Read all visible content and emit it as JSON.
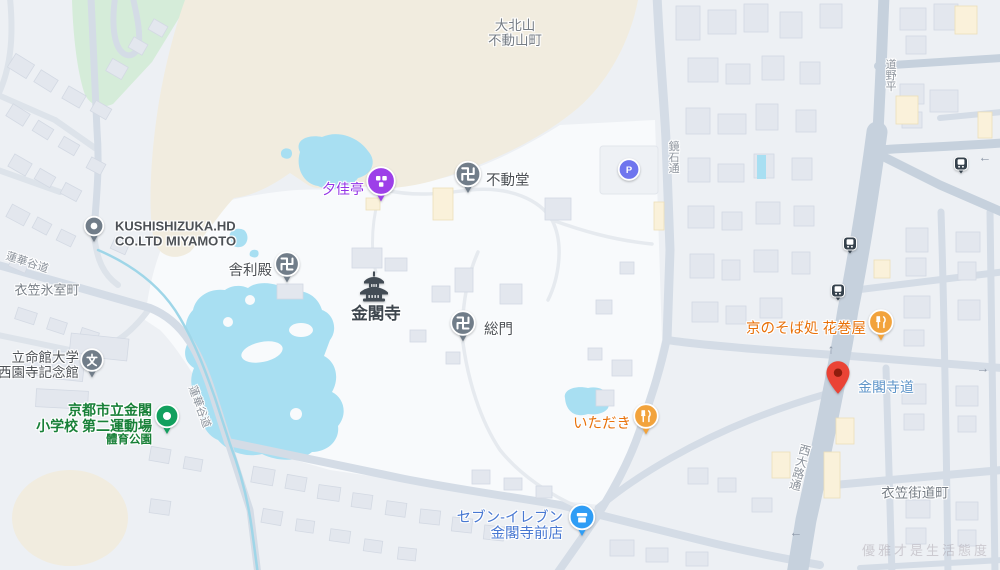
{
  "map": {
    "watermark": "優雅才是生活態度",
    "palette": {
      "features": {
        "land": "#edf0f4",
        "temple": "#f8fafc",
        "green": "#d5ecd9",
        "beige": "#f1ecdf",
        "water": "#a8dff2",
        "stream": "#9fd6e8",
        "roadMajor": "#c6d1dd",
        "roadMinor": "#d4dce6",
        "lane": "#dde3ea",
        "tpath": "#e6eaef",
        "bldg": "#e3e7ee",
        "bldgStroke": "#d3d9e3",
        "bldgBeige": "#faf1da",
        "bldgBeigeStroke": "#eddfb9"
      },
      "text": {
        "dark": "#4d5156",
        "kinkakuji": "#3e464e",
        "area": "#767d85",
        "road": "#8c939c",
        "purple": "#9334e6",
        "orange": "#e8710a",
        "blue": "#4878d2",
        "green": "#188038",
        "transit": "#5f95c9"
      },
      "markers": {
        "grey": "#717d89",
        "purple": "#9d3fe8",
        "orange": "#f2a33c",
        "blue": "#2f9df5",
        "green": "#12a05e",
        "parking": "#6f75ee",
        "bus": "#36424d",
        "pin_red": "#ea4335",
        "pin_red_dark": "#8f1d0d",
        "pagoda": "#434c55"
      }
    },
    "labels": [
      {
        "id": "daikitayama-fudosancho",
        "lines": [
          "大北山",
          "不動山町"
        ],
        "x": 515,
        "y": 33,
        "size": 13.5,
        "weight": 400,
        "color": "area",
        "align": "center",
        "interactable": false
      },
      {
        "id": "kinugasa-himurocho",
        "lines": [
          "衣笠氷室町"
        ],
        "x": 47,
        "y": 291,
        "size": 13,
        "weight": 400,
        "color": "area",
        "align": "center",
        "interactable": false
      },
      {
        "id": "kinugasa-kaidocho",
        "lines": [
          "衣笠街道町"
        ],
        "x": 915,
        "y": 493,
        "size": 13.5,
        "weight": 400,
        "color": "area",
        "align": "center",
        "interactable": false
      },
      {
        "id": "kushishizuka",
        "lines": [
          "KUSHISHIZUKA.HD",
          "CO.LTD MIYAMOTO"
        ],
        "x": 115,
        "y": 234,
        "size": 13,
        "weight": 700,
        "color": "dark",
        "align": "left",
        "interactable": true
      },
      {
        "id": "yukatei",
        "lines": [
          "夕佳亭"
        ],
        "x": 364,
        "y": 190,
        "size": 14,
        "weight": 500,
        "color": "purple",
        "align": "right",
        "interactable": true
      },
      {
        "id": "fudodo",
        "lines": [
          "不動堂"
        ],
        "x": 486,
        "y": 181,
        "size": 14.5,
        "weight": 500,
        "color": "dark",
        "align": "left",
        "interactable": true
      },
      {
        "id": "shariden",
        "lines": [
          "舎利殿"
        ],
        "x": 272,
        "y": 271,
        "size": 14.5,
        "weight": 500,
        "color": "dark",
        "align": "right",
        "interactable": true
      },
      {
        "id": "kinkakuji",
        "lines": [
          "金閣寺"
        ],
        "x": 376,
        "y": 314,
        "size": 16.5,
        "weight": 700,
        "color": "kinkakuji",
        "align": "center",
        "interactable": true
      },
      {
        "id": "somon",
        "lines": [
          "総門"
        ],
        "x": 484,
        "y": 330,
        "size": 14.5,
        "weight": 500,
        "color": "dark",
        "align": "left",
        "interactable": true
      },
      {
        "id": "ritsumeikan",
        "lines": [
          "立命館大学",
          "西園寺記念館"
        ],
        "x": 79,
        "y": 365,
        "size": 13.5,
        "weight": 500,
        "color": "dark",
        "align": "right",
        "interactable": true
      },
      {
        "id": "kinkaku-elementary",
        "lines": [
          "京都市立金閣",
          "小学校 第二運動場",
          "體育公園"
        ],
        "line_sizes": [
          14,
          14,
          11.5
        ],
        "x": 152,
        "y": 425,
        "size": 14,
        "weight": 700,
        "color": "green",
        "align": "right",
        "interactable": true
      },
      {
        "id": "itadaki",
        "lines": [
          "いただき"
        ],
        "x": 631,
        "y": 424,
        "size": 14.5,
        "weight": 500,
        "color": "orange",
        "align": "right",
        "interactable": true
      },
      {
        "id": "seven-eleven",
        "lines": [
          "セブン-イレブン",
          "金閣寺前店"
        ],
        "x": 563,
        "y": 526,
        "size": 14.5,
        "weight": 500,
        "color": "blue",
        "align": "right",
        "interactable": true
      },
      {
        "id": "hanamakiya",
        "lines": [
          "京のそば処 花巻屋"
        ],
        "x": 866,
        "y": 329,
        "size": 14.5,
        "weight": 500,
        "color": "orange",
        "align": "right",
        "interactable": true
      },
      {
        "id": "kinkakujimichi-stop",
        "lines": [
          "金閣寺道"
        ],
        "x": 858,
        "y": 388,
        "size": 14,
        "weight": 500,
        "color": "transit",
        "align": "left",
        "interactable": true
      },
      {
        "id": "road-rengedani-1",
        "lines": [
          "蓮華谷道"
        ],
        "x": 27,
        "y": 263,
        "size": 11,
        "weight": 400,
        "color": "road",
        "align": "center",
        "rotate": 18,
        "interactable": false
      },
      {
        "id": "road-rengedani-2",
        "lines": [
          "蓮華谷道"
        ],
        "x": 199,
        "y": 407,
        "size": 11,
        "weight": 400,
        "color": "road",
        "align": "center",
        "rotate": 70,
        "interactable": false
      },
      {
        "id": "road-kagamiishi",
        "lines": [
          "鏡石通"
        ],
        "x": 673,
        "y": 157,
        "size": 11,
        "weight": 400,
        "color": "road",
        "align": "center",
        "vertical": true,
        "interactable": false
      },
      {
        "id": "road-hirano",
        "lines": [
          "平野道"
        ],
        "x": 890,
        "y": 75,
        "size": 11,
        "weight": 400,
        "color": "road",
        "align": "center",
        "vertical": true,
        "reverse": true,
        "interactable": false
      },
      {
        "id": "road-nishioji",
        "lines": [
          "西大路通"
        ],
        "x": 799,
        "y": 467,
        "size": 12,
        "weight": 400,
        "color": "road",
        "align": "center",
        "vertical": true,
        "rotate": 15,
        "interactable": false
      }
    ],
    "markers": [
      {
        "id": "kushishizuka",
        "name": "marker-kushishizuka-place",
        "type": "dot",
        "color": "grey",
        "x": 94,
        "y": 232,
        "size": 21,
        "interactable": true
      },
      {
        "id": "yukatei",
        "name": "marker-yukatei-attraction",
        "type": "squares",
        "color": "purple",
        "x": 381,
        "y": 187,
        "size": 30,
        "interactable": true
      },
      {
        "id": "fudodo",
        "name": "marker-fudodo-temple",
        "type": "manji",
        "color": "grey",
        "x": 468,
        "y": 180,
        "size": 27,
        "interactable": true
      },
      {
        "id": "parking",
        "name": "marker-parking",
        "type": "parking",
        "color": "parking",
        "x": 629,
        "y": 172,
        "size": 23,
        "interactable": true
      },
      {
        "id": "shariden",
        "name": "marker-shariden-temple",
        "type": "manji",
        "color": "grey",
        "x": 287,
        "y": 270,
        "size": 26,
        "interactable": true
      },
      {
        "id": "kinkakuji",
        "name": "kinkakuji-pagoda-icon",
        "type": "pagoda",
        "color": "pagoda",
        "x": 374,
        "y": 289,
        "size": 36,
        "interactable": true
      },
      {
        "id": "somon",
        "name": "marker-somon-temple",
        "type": "manji",
        "color": "grey",
        "x": 463,
        "y": 329,
        "size": 26,
        "interactable": true
      },
      {
        "id": "ritsumeikan",
        "name": "marker-ritsumeikan-school",
        "type": "school",
        "color": "grey",
        "x": 92,
        "y": 366,
        "size": 24,
        "interactable": true
      },
      {
        "id": "elementary",
        "name": "marker-kinkaku-elementary-park",
        "type": "parkdot",
        "color": "green",
        "x": 167,
        "y": 422,
        "size": 25,
        "interactable": true
      },
      {
        "id": "itadaki",
        "name": "marker-itadaki-restaurant",
        "type": "restaurant",
        "color": "orange",
        "x": 646,
        "y": 422,
        "size": 26,
        "interactable": true
      },
      {
        "id": "seven",
        "name": "marker-seven-eleven-store",
        "type": "store",
        "color": "blue",
        "x": 582,
        "y": 523,
        "size": 27,
        "interactable": true
      },
      {
        "id": "hanamakiya",
        "name": "marker-hanamakiya-restaurant",
        "type": "restaurant",
        "color": "orange",
        "x": 881,
        "y": 328,
        "size": 26,
        "interactable": true
      },
      {
        "id": "destination",
        "name": "destination-pin",
        "type": "pin",
        "color": "pin_red",
        "x": 838,
        "y": 399,
        "size": 23,
        "interactable": true
      },
      {
        "id": "bus1",
        "name": "bus-stop-icon",
        "type": "bus",
        "color": "bus",
        "x": 961,
        "y": 168,
        "size": 14,
        "interactable": true
      },
      {
        "id": "bus2",
        "name": "bus-stop-icon",
        "type": "bus",
        "color": "bus",
        "x": 850,
        "y": 248,
        "size": 14,
        "interactable": true
      },
      {
        "id": "bus3",
        "name": "bus-stop-icon",
        "type": "bus",
        "color": "bus",
        "x": 838,
        "y": 295,
        "size": 14,
        "interactable": true
      }
    ],
    "arrows": [
      {
        "dir": "left",
        "x": 985,
        "y": 157
      },
      {
        "dir": "up",
        "x": 831,
        "y": 349
      },
      {
        "dir": "right",
        "x": 983,
        "y": 368
      },
      {
        "dir": "left",
        "x": 796,
        "y": 532
      }
    ]
  }
}
